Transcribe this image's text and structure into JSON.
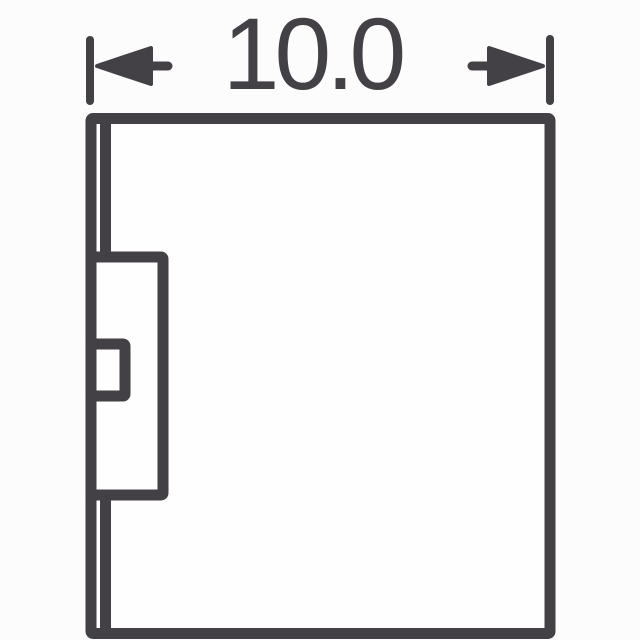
{
  "dimension": {
    "label": "10.0"
  },
  "colors": {
    "line": "#434046",
    "bodyFill": "#fefefe",
    "background": "#fcfcfd"
  }
}
